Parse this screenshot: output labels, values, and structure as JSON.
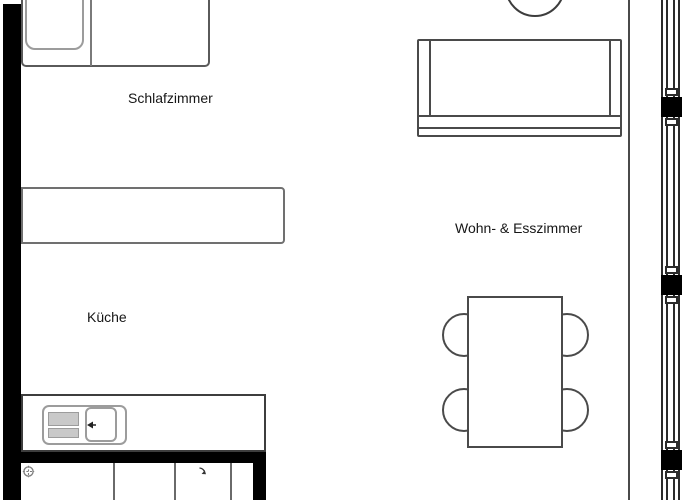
{
  "palette": {
    "background": "#ffffff",
    "wall_black": "#000000",
    "outline_dark": "#3d3d3d",
    "outline_mid": "#707070",
    "outline_light": "#9c9c9c",
    "drainer_gray": "#c9c9c9",
    "text_color": "#161616"
  },
  "labels": {
    "bedroom": "Schlafzimmer",
    "kitchen": "Küche",
    "living_dining": "Wohn- & Esszimmer"
  },
  "window_wall": {
    "glazing_posts": 3,
    "pane_lines": 4
  },
  "furniture": {
    "bedroom": [
      "bed",
      "pillow"
    ],
    "kitchen": [
      "counter",
      "sink-counter",
      "sink",
      "drainer"
    ],
    "living_dining": [
      "sofa",
      "side-table-circle",
      "dining-table"
    ],
    "dining_chairs": 4
  },
  "icons": {
    "drain": "circle-cross",
    "appliance_arrow": "diagonal-arrow",
    "faucet": "tap-arrow"
  }
}
